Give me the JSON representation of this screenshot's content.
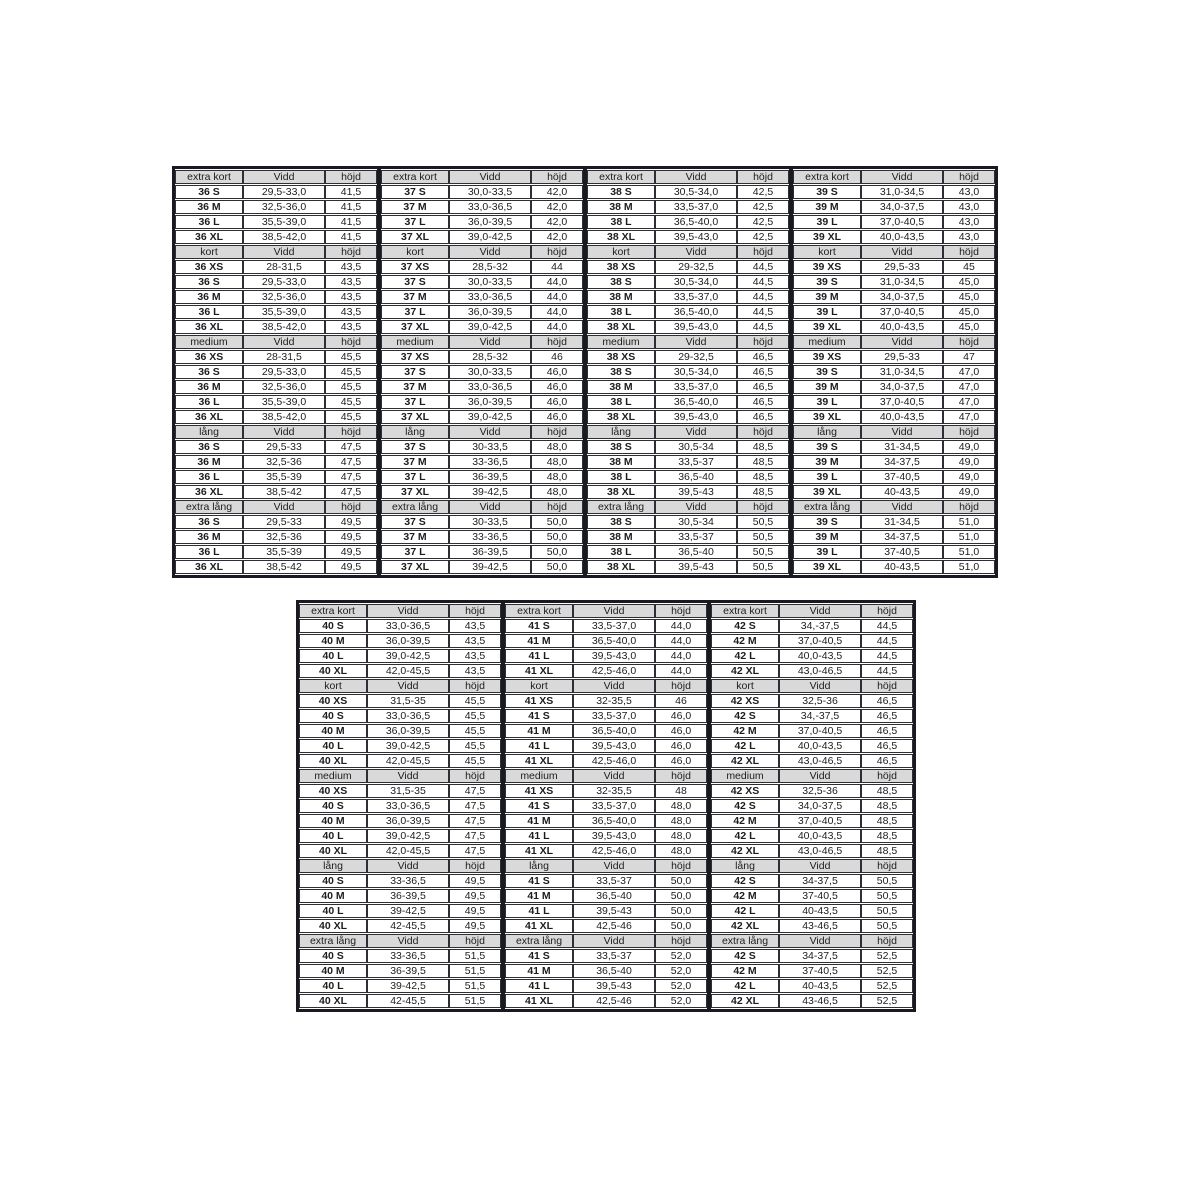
{
  "page": {
    "background": "#ffffff"
  },
  "theme": {
    "header_bg": "#d9d9d9",
    "frame_color": "#191921",
    "cell_border": "#2e2e35",
    "text_color": "#1d1d1d"
  },
  "measure_headers": {
    "vidd": "Vidd",
    "hojd": "höjd"
  },
  "tables": [
    {
      "id": "size-table-36-39",
      "group_count": 4,
      "sections": [
        {
          "label": "extra kort",
          "rows": [
            [
              "36 S",
              "29,5-33,0",
              "41,5",
              "37 S",
              "30,0-33,5",
              "42,0",
              "38 S",
              "30,5-34,0",
              "42,5",
              "39 S",
              "31,0-34,5",
              "43,0"
            ],
            [
              "36 M",
              "32,5-36,0",
              "41,5",
              "37 M",
              "33,0-36,5",
              "42,0",
              "38 M",
              "33,5-37,0",
              "42,5",
              "39 M",
              "34,0-37,5",
              "43,0"
            ],
            [
              "36 L",
              "35,5-39,0",
              "41,5",
              "37 L",
              "36,0-39,5",
              "42,0",
              "38 L",
              "36,5-40,0",
              "42,5",
              "39 L",
              "37,0-40,5",
              "43,0"
            ],
            [
              "36 XL",
              "38,5-42,0",
              "41,5",
              "37 XL",
              "39,0-42,5",
              "42,0",
              "38 XL",
              "39,5-43,0",
              "42,5",
              "39 XL",
              "40,0-43,5",
              "43,0"
            ]
          ]
        },
        {
          "label": "kort",
          "rows": [
            [
              "36 XS",
              "28-31,5",
              "43,5",
              "37 XS",
              "28,5-32",
              "44",
              "38 XS",
              "29-32,5",
              "44,5",
              "39 XS",
              "29,5-33",
              "45"
            ],
            [
              "36 S",
              "29,5-33,0",
              "43,5",
              "37 S",
              "30,0-33,5",
              "44,0",
              "38 S",
              "30,5-34,0",
              "44,5",
              "39 S",
              "31,0-34,5",
              "45,0"
            ],
            [
              "36 M",
              "32,5-36,0",
              "43,5",
              "37 M",
              "33,0-36,5",
              "44,0",
              "38 M",
              "33,5-37,0",
              "44,5",
              "39 M",
              "34,0-37,5",
              "45,0"
            ],
            [
              "36 L",
              "35,5-39,0",
              "43,5",
              "37 L",
              "36,0-39,5",
              "44,0",
              "38 L",
              "36,5-40,0",
              "44,5",
              "39 L",
              "37,0-40,5",
              "45,0"
            ],
            [
              "36 XL",
              "38,5-42,0",
              "43,5",
              "37 XL",
              "39,0-42,5",
              "44,0",
              "38 XL",
              "39,5-43,0",
              "44,5",
              "39 XL",
              "40,0-43,5",
              "45,0"
            ]
          ]
        },
        {
          "label": "medium",
          "rows": [
            [
              "36 XS",
              "28-31,5",
              "45,5",
              "37 XS",
              "28,5-32",
              "46",
              "38 XS",
              "29-32,5",
              "46,5",
              "39 XS",
              "29,5-33",
              "47"
            ],
            [
              "36 S",
              "29,5-33,0",
              "45,5",
              "37 S",
              "30,0-33,5",
              "46,0",
              "38 S",
              "30,5-34,0",
              "46,5",
              "39 S",
              "31,0-34,5",
              "47,0"
            ],
            [
              "36 M",
              "32,5-36,0",
              "45,5",
              "37 M",
              "33,0-36,5",
              "46,0",
              "38 M",
              "33,5-37,0",
              "46,5",
              "39 M",
              "34,0-37,5",
              "47,0"
            ],
            [
              "36 L",
              "35,5-39,0",
              "45,5",
              "37 L",
              "36,0-39,5",
              "46,0",
              "38 L",
              "36,5-40,0",
              "46,5",
              "39 L",
              "37,0-40,5",
              "47,0"
            ],
            [
              "36 XL",
              "38,5-42,0",
              "45,5",
              "37 XL",
              "39,0-42,5",
              "46,0",
              "38 XL",
              "39,5-43,0",
              "46,5",
              "39 XL",
              "40,0-43,5",
              "47,0"
            ]
          ]
        },
        {
          "label": "lång",
          "rows": [
            [
              "36 S",
              "29,5-33",
              "47,5",
              "37 S",
              "30-33,5",
              "48,0",
              "38 S",
              "30,5-34",
              "48,5",
              "39 S",
              "31-34,5",
              "49,0"
            ],
            [
              "36 M",
              "32,5-36",
              "47,5",
              "37 M",
              "33-36,5",
              "48,0",
              "38 M",
              "33,5-37",
              "48,5",
              "39 M",
              "34-37,5",
              "49,0"
            ],
            [
              "36 L",
              "35,5-39",
              "47,5",
              "37 L",
              "36-39,5",
              "48,0",
              "38 L",
              "36,5-40",
              "48,5",
              "39 L",
              "37-40,5",
              "49,0"
            ],
            [
              "36 XL",
              "38,5-42",
              "47,5",
              "37 XL",
              "39-42,5",
              "48,0",
              "38 XL",
              "39,5-43",
              "48,5",
              "39 XL",
              "40-43,5",
              "49,0"
            ]
          ]
        },
        {
          "label": "extra lång",
          "rows": [
            [
              "36 S",
              "29,5-33",
              "49,5",
              "37 S",
              "30-33,5",
              "50,0",
              "38 S",
              "30,5-34",
              "50,5",
              "39 S",
              "31-34,5",
              "51,0"
            ],
            [
              "36 M",
              "32,5-36",
              "49,5",
              "37 M",
              "33-36,5",
              "50,0",
              "38 M",
              "33,5-37",
              "50,5",
              "39 M",
              "34-37,5",
              "51,0"
            ],
            [
              "36 L",
              "35,5-39",
              "49,5",
              "37 L",
              "36-39,5",
              "50,0",
              "38 L",
              "36,5-40",
              "50,5",
              "39 L",
              "37-40,5",
              "51,0"
            ],
            [
              "36 XL",
              "38,5-42",
              "49,5",
              "37 XL",
              "39-42,5",
              "50,0",
              "38 XL",
              "39,5-43",
              "50,5",
              "39 XL",
              "40-43,5",
              "51,0"
            ]
          ]
        }
      ]
    },
    {
      "id": "size-table-40-42",
      "group_count": 3,
      "sections": [
        {
          "label": "extra kort",
          "rows": [
            [
              "40 S",
              "33,0-36,5",
              "43,5",
              "41 S",
              "33,5-37,0",
              "44,0",
              "42 S",
              "34,-37,5",
              "44,5"
            ],
            [
              "40 M",
              "36,0-39,5",
              "43,5",
              "41 M",
              "36,5-40,0",
              "44,0",
              "42 M",
              "37,0-40,5",
              "44,5"
            ],
            [
              "40 L",
              "39,0-42,5",
              "43,5",
              "41 L",
              "39,5-43,0",
              "44,0",
              "42 L",
              "40,0-43,5",
              "44,5"
            ],
            [
              "40 XL",
              "42,0-45,5",
              "43,5",
              "41 XL",
              "42,5-46,0",
              "44,0",
              "42 XL",
              "43,0-46,5",
              "44,5"
            ]
          ]
        },
        {
          "label": "kort",
          "rows": [
            [
              "40 XS",
              "31,5-35",
              "45,5",
              "41 XS",
              "32-35,5",
              "46",
              "42 XS",
              "32,5-36",
              "46,5"
            ],
            [
              "40 S",
              "33,0-36,5",
              "45,5",
              "41 S",
              "33,5-37,0",
              "46,0",
              "42 S",
              "34,-37,5",
              "46,5"
            ],
            [
              "40 M",
              "36,0-39,5",
              "45,5",
              "41 M",
              "36,5-40,0",
              "46,0",
              "42 M",
              "37,0-40,5",
              "46,5"
            ],
            [
              "40 L",
              "39,0-42,5",
              "45,5",
              "41 L",
              "39,5-43,0",
              "46,0",
              "42 L",
              "40,0-43,5",
              "46,5"
            ],
            [
              "40 XL",
              "42,0-45,5",
              "45,5",
              "41 XL",
              "42,5-46,0",
              "46,0",
              "42 XL",
              "43,0-46,5",
              "46,5"
            ]
          ]
        },
        {
          "label": "medium",
          "rows": [
            [
              "40 XS",
              "31,5-35",
              "47,5",
              "41 XS",
              "32-35,5",
              "48",
              "42 XS",
              "32,5-36",
              "48,5"
            ],
            [
              "40 S",
              "33,0-36,5",
              "47,5",
              "41 S",
              "33,5-37,0",
              "48,0",
              "42 S",
              "34,0-37,5",
              "48,5"
            ],
            [
              "40 M",
              "36,0-39,5",
              "47,5",
              "41 M",
              "36,5-40,0",
              "48,0",
              "42 M",
              "37,0-40,5",
              "48,5"
            ],
            [
              "40 L",
              "39,0-42,5",
              "47,5",
              "41 L",
              "39,5-43,0",
              "48,0",
              "42 L",
              "40,0-43,5",
              "48,5"
            ],
            [
              "40 XL",
              "42,0-45,5",
              "47,5",
              "41 XL",
              "42,5-46,0",
              "48,0",
              "42 XL",
              "43,0-46,5",
              "48,5"
            ]
          ]
        },
        {
          "label": "lång",
          "rows": [
            [
              "40 S",
              "33-36,5",
              "49,5",
              "41 S",
              "33,5-37",
              "50,0",
              "42 S",
              "34-37,5",
              "50,5"
            ],
            [
              "40 M",
              "36-39,5",
              "49,5",
              "41 M",
              "36,5-40",
              "50,0",
              "42 M",
              "37-40,5",
              "50,5"
            ],
            [
              "40 L",
              "39-42,5",
              "49,5",
              "41 L",
              "39,5-43",
              "50,0",
              "42 L",
              "40-43,5",
              "50,5"
            ],
            [
              "40 XL",
              "42-45,5",
              "49,5",
              "41 XL",
              "42,5-46",
              "50,0",
              "42 XL",
              "43-46,5",
              "50,5"
            ]
          ]
        },
        {
          "label": "extra lång",
          "rows": [
            [
              "40 S",
              "33-36,5",
              "51,5",
              "41 S",
              "33,5-37",
              "52,0",
              "42 S",
              "34-37,5",
              "52,5"
            ],
            [
              "40 M",
              "36-39,5",
              "51,5",
              "41 M",
              "36,5-40",
              "52,0",
              "42 M",
              "37-40,5",
              "52,5"
            ],
            [
              "40 L",
              "39-42,5",
              "51,5",
              "41 L",
              "39,5-43",
              "52,0",
              "42 L",
              "40-43,5",
              "52,5"
            ],
            [
              "40 XL",
              "42-45,5",
              "51,5",
              "41 XL",
              "42,5-46",
              "52,0",
              "42 XL",
              "43-46,5",
              "52,5"
            ]
          ]
        }
      ]
    }
  ]
}
